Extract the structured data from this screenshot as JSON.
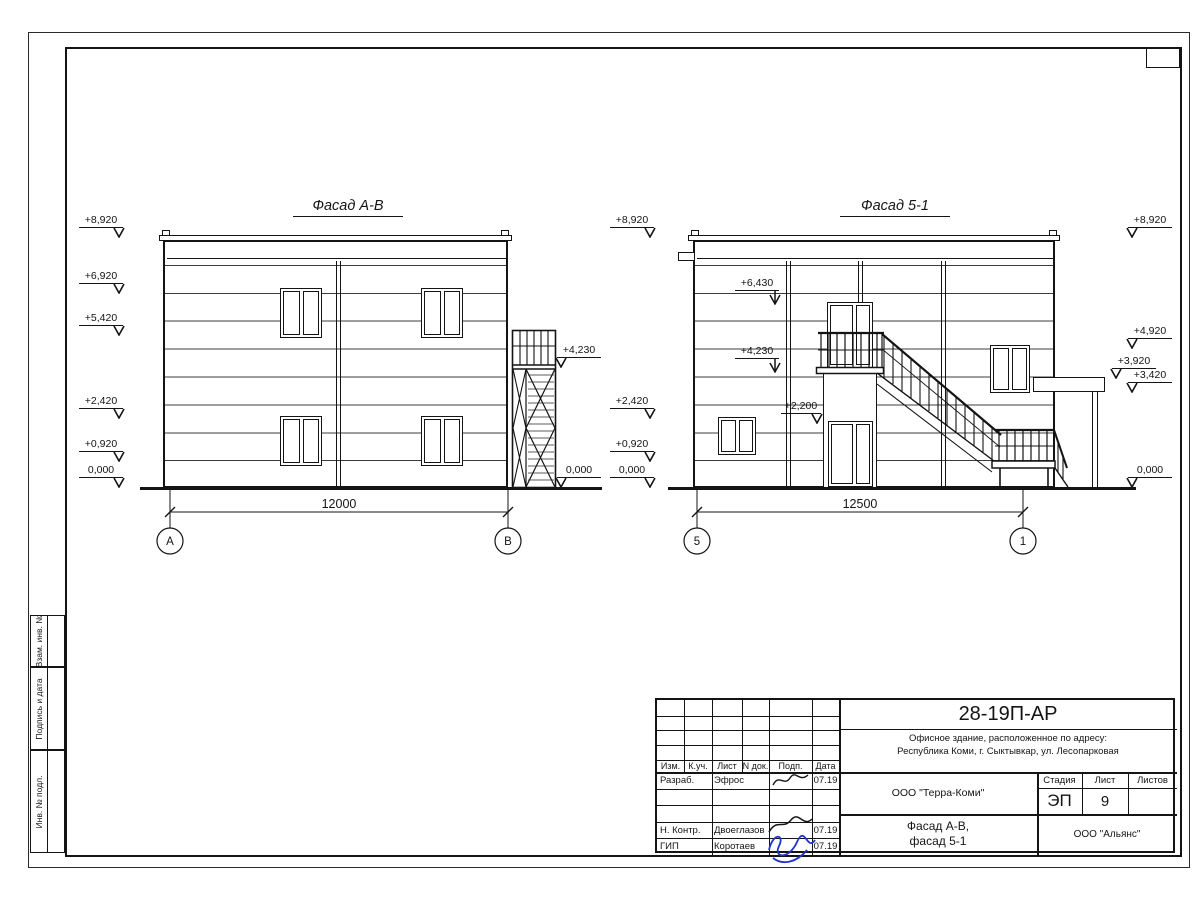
{
  "drawing": {
    "facade_left": {
      "title": "Фасад А-В",
      "dimension": "12000",
      "axis_start": "А",
      "axis_end": "В",
      "elev_left": [
        "+8,920",
        "+6,920",
        "+5,420",
        "+2,420",
        "+0,920",
        "0,000"
      ],
      "elev_right": [
        "+4,230",
        "0,000"
      ]
    },
    "facade_right": {
      "title": "Фасад 5-1",
      "dimension": "12500",
      "axis_start": "5",
      "axis_end": "1",
      "elev_left": [
        "+8,920",
        "+2,420",
        "+0,920",
        "0,000"
      ],
      "elev_mid": [
        "+6,430",
        "+4,230",
        "+2,200"
      ],
      "elev_right": [
        "+8,920",
        "+4,920",
        "+3,920",
        "+3,420",
        "0,000"
      ]
    }
  },
  "title_block": {
    "doc_number": "28-19П-АР",
    "project_line1": "Офисное здание, расположенное по адресу:",
    "project_line2": "Республика Коми, г. Сыктывкар, ул. Лесопарковая",
    "col_izm": "Изм.",
    "col_kuch": "К.уч.",
    "col_list": "Лист",
    "col_ndok": "N док.",
    "col_podp": "Подп.",
    "col_data": "Дата",
    "rows": [
      {
        "role": "Разраб.",
        "name": "Эфрос",
        "date": "07.19"
      },
      {
        "role": "",
        "name": "",
        "date": ""
      },
      {
        "role": "",
        "name": "",
        "date": ""
      },
      {
        "role": "Н. Контр.",
        "name": "Двоеглазов",
        "date": "07.19"
      },
      {
        "role": "ГИП",
        "name": "Коротаев",
        "date": "07.19"
      }
    ],
    "org": "ООО \"Терра-Коми\"",
    "stage_label": "Стадия",
    "sheet_label": "Лист",
    "sheets_label": "Листов",
    "stage": "ЭП",
    "sheet": "9",
    "sheets": "",
    "subject_line1": "Фасад А-В,",
    "subject_line2": "фасад 5-1",
    "contractor": "ООО \"Альянс\"",
    "signature_color": "#2233cc",
    "line_color": "#141414"
  },
  "margin": {
    "box1": "Взам. инв. №",
    "box2": "Подпись и дата",
    "box3": "Инв. № подл."
  }
}
